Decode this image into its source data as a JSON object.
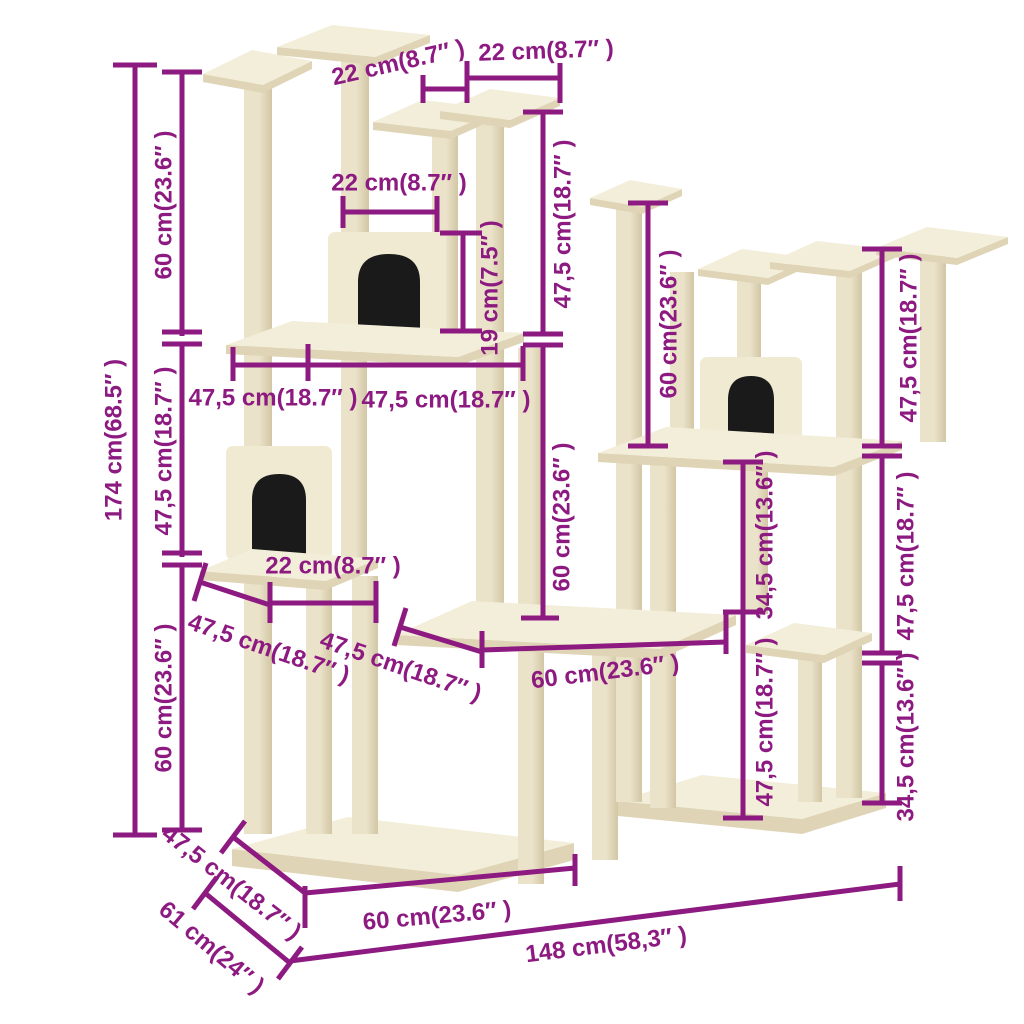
{
  "figure": {
    "subject": "cat-tree-dimension-diagram",
    "units": [
      "cm",
      "inches"
    ]
  },
  "colors": {
    "background": "#FFFFFF",
    "dimension": "#8D1A81",
    "cream_top": "#F3EED9",
    "cream_edge": "#DFD4B6",
    "post_light": "#EAE2C9",
    "post_dark": "#D2C6A4",
    "house_front": "#F0EAD3",
    "opening": "#1A1A1A"
  },
  "dims": [
    {
      "id": "height-overall",
      "cm": 174,
      "in": 68.5,
      "label": "174 cm(68.5″ )"
    },
    {
      "id": "left-section-top",
      "cm": 60,
      "in": 23.6,
      "label": "60 cm(23.6″ )"
    },
    {
      "id": "left-section-mid",
      "cm": 47.5,
      "in": 18.7,
      "label": "47,5 cm(18.7″ )"
    },
    {
      "id": "left-section-bottom",
      "cm": 60,
      "in": 23.6,
      "label": "60 cm(23.6″ )"
    },
    {
      "id": "top-platform-left",
      "cm": 22,
      "in": 8.7,
      "label": "22 cm(8.7″ )"
    },
    {
      "id": "top-platform-right",
      "cm": 22,
      "in": 8.7,
      "label": "22 cm(8.7″ )"
    },
    {
      "id": "upper-house-width",
      "cm": 22,
      "in": 8.7,
      "label": "22 cm(8.7″ )"
    },
    {
      "id": "top-center-height",
      "cm": 47.5,
      "in": 18.7,
      "label": "47,5 cm(18.7″ )"
    },
    {
      "id": "house-post-offset",
      "cm": 19,
      "in": 7.5,
      "label": "19 cm(7.5″ )"
    },
    {
      "id": "shelf-width-left",
      "cm": 47.5,
      "in": 18.7,
      "label": "47,5 cm(18.7″ )"
    },
    {
      "id": "shelf-width-right",
      "cm": 47.5,
      "in": 18.7,
      "label": "47,5 cm(18.7″ )"
    },
    {
      "id": "center-column-height",
      "cm": 60,
      "in": 23.6,
      "label": "60 cm(23.6″ )"
    },
    {
      "id": "right-tower-height",
      "cm": 60,
      "in": 23.6,
      "label": "60 cm(23.6″ )"
    },
    {
      "id": "far-right-top",
      "cm": 47.5,
      "in": 18.7,
      "label": "47,5 cm(18.7″ )"
    },
    {
      "id": "lower-house-width",
      "cm": 22,
      "in": 8.7,
      "label": "22 cm(8.7″ )"
    },
    {
      "id": "lower-platform-depth",
      "cm": 47.5,
      "in": 18.7,
      "label": "47,5 cm(18.7″ )"
    },
    {
      "id": "middle-platform-depth",
      "cm": 47.5,
      "in": 18.7,
      "label": "47,5 cm(18.7″ )"
    },
    {
      "id": "middle-width",
      "cm": 60,
      "in": 23.6,
      "label": "60 cm(23.6″ )"
    },
    {
      "id": "center-right-upper",
      "cm": 34.5,
      "in": 13.6,
      "label": "34,5 cm(13.6″ )"
    },
    {
      "id": "center-right-lower",
      "cm": 47.5,
      "in": 18.7,
      "label": "47,5 cm(18.7″ )"
    },
    {
      "id": "far-right-mid",
      "cm": 47.5,
      "in": 18.7,
      "label": "47,5 cm(18.7″ )"
    },
    {
      "id": "far-right-bottom",
      "cm": 34.5,
      "in": 13.6,
      "label": "34,5 cm(13.6″ )"
    },
    {
      "id": "base-depth-inner",
      "cm": 47.5,
      "in": 18.7,
      "label": "47,5 cm(18.7″ )"
    },
    {
      "id": "base-depth-outer",
      "cm": 61,
      "in": 24,
      "label": "61 cm(24″ )"
    },
    {
      "id": "base-width",
      "cm": 60,
      "in": 23.6,
      "label": "60 cm(23.6″ )"
    },
    {
      "id": "overall-width",
      "cm": 148,
      "in": 58.3,
      "label": "148 cm(58,3″ )"
    }
  ]
}
